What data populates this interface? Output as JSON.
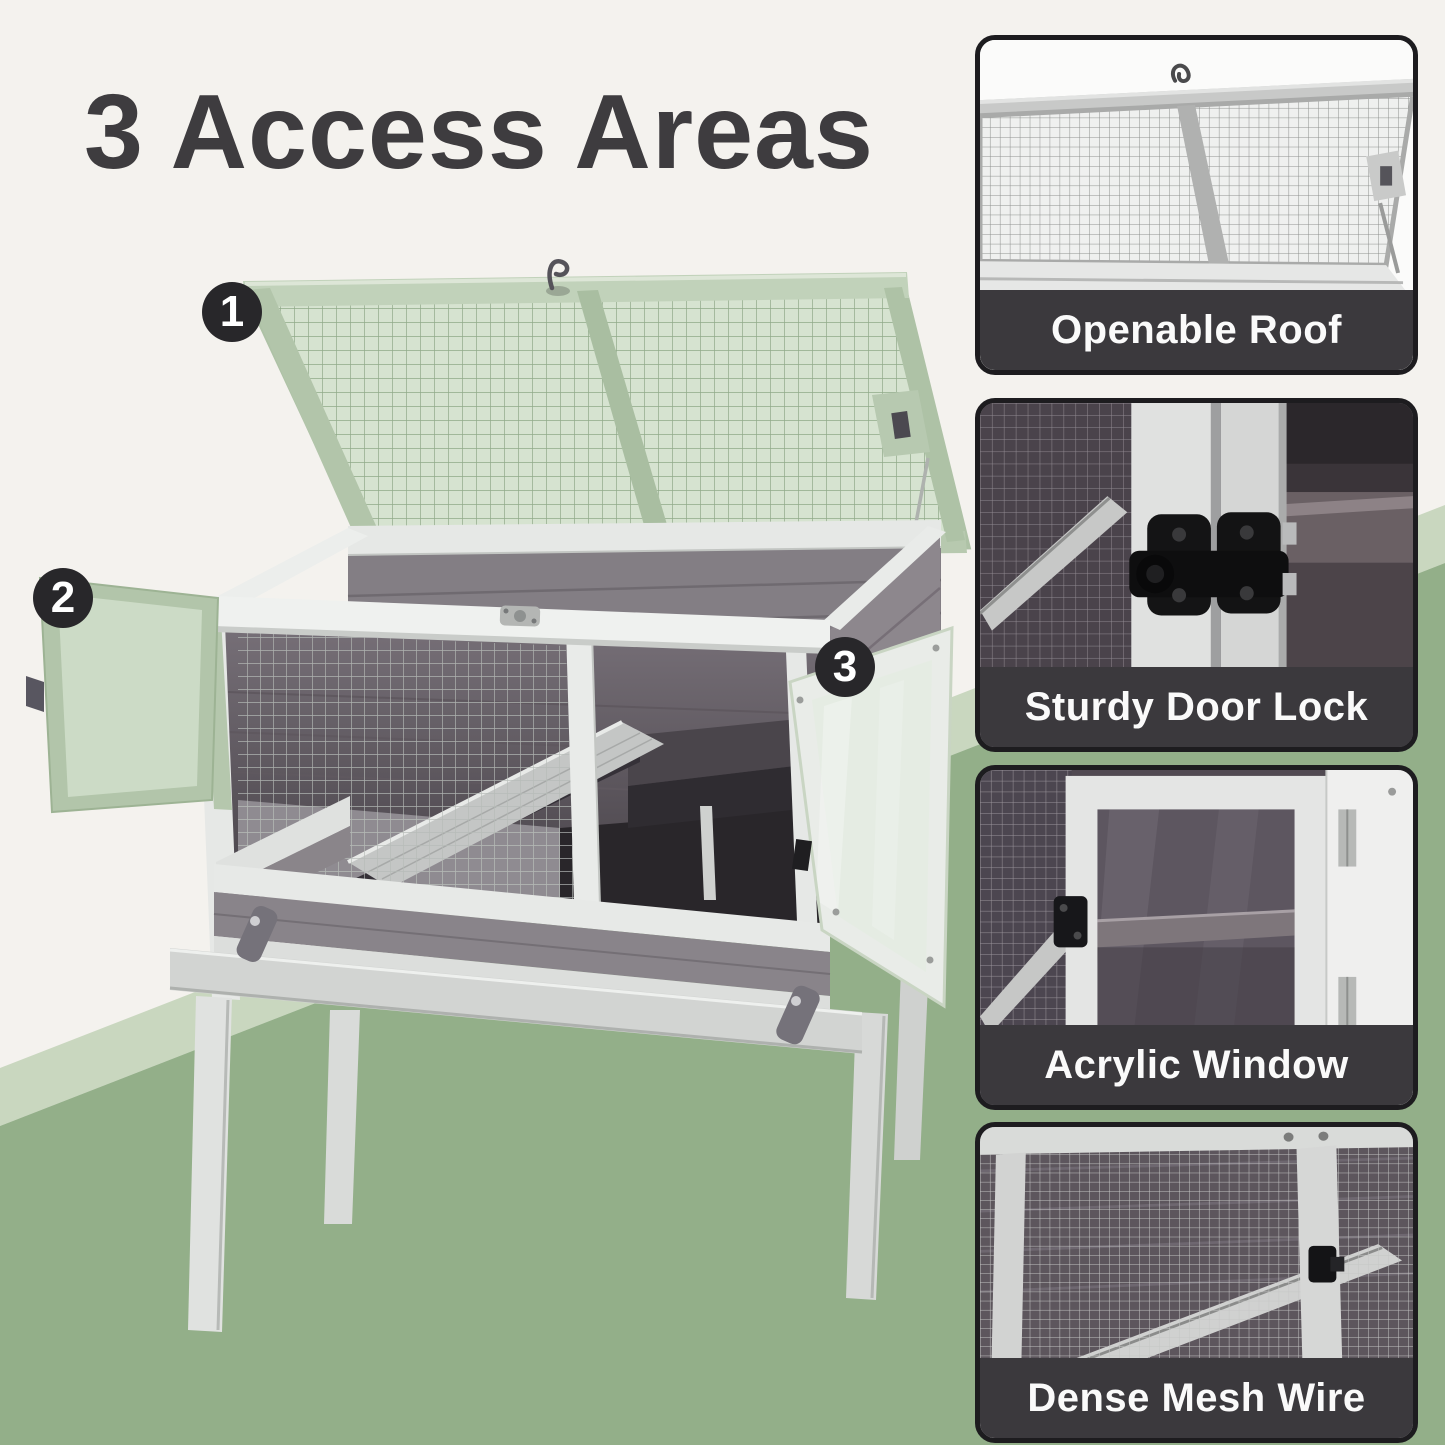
{
  "title": "3 Access Areas",
  "callouts": [
    {
      "number": "1"
    },
    {
      "number": "2"
    },
    {
      "number": "3"
    }
  ],
  "panels": [
    {
      "caption": "Openable Roof"
    },
    {
      "caption": "Sturdy Door Lock"
    },
    {
      "caption": "Acrylic Window"
    },
    {
      "caption": "Dense Mesh Wire"
    }
  ],
  "colors": {
    "background_cream": "#f4f2ee",
    "floor_green": "#93af89",
    "floor_green_light": "#c9d7bf",
    "title_text": "#3e3c3f",
    "badge_bg": "#28272a",
    "badge_text": "#ffffff",
    "panel_border": "#1d1c1f",
    "caption_bg": "#3b393d",
    "caption_text": "#fafafa",
    "cage_mesh_green": "#cfe0ca",
    "cage_frame_sage": "#b2c5aa",
    "cage_wood_white": "#e9ebe9",
    "cage_wood_dark": "#837e84"
  }
}
